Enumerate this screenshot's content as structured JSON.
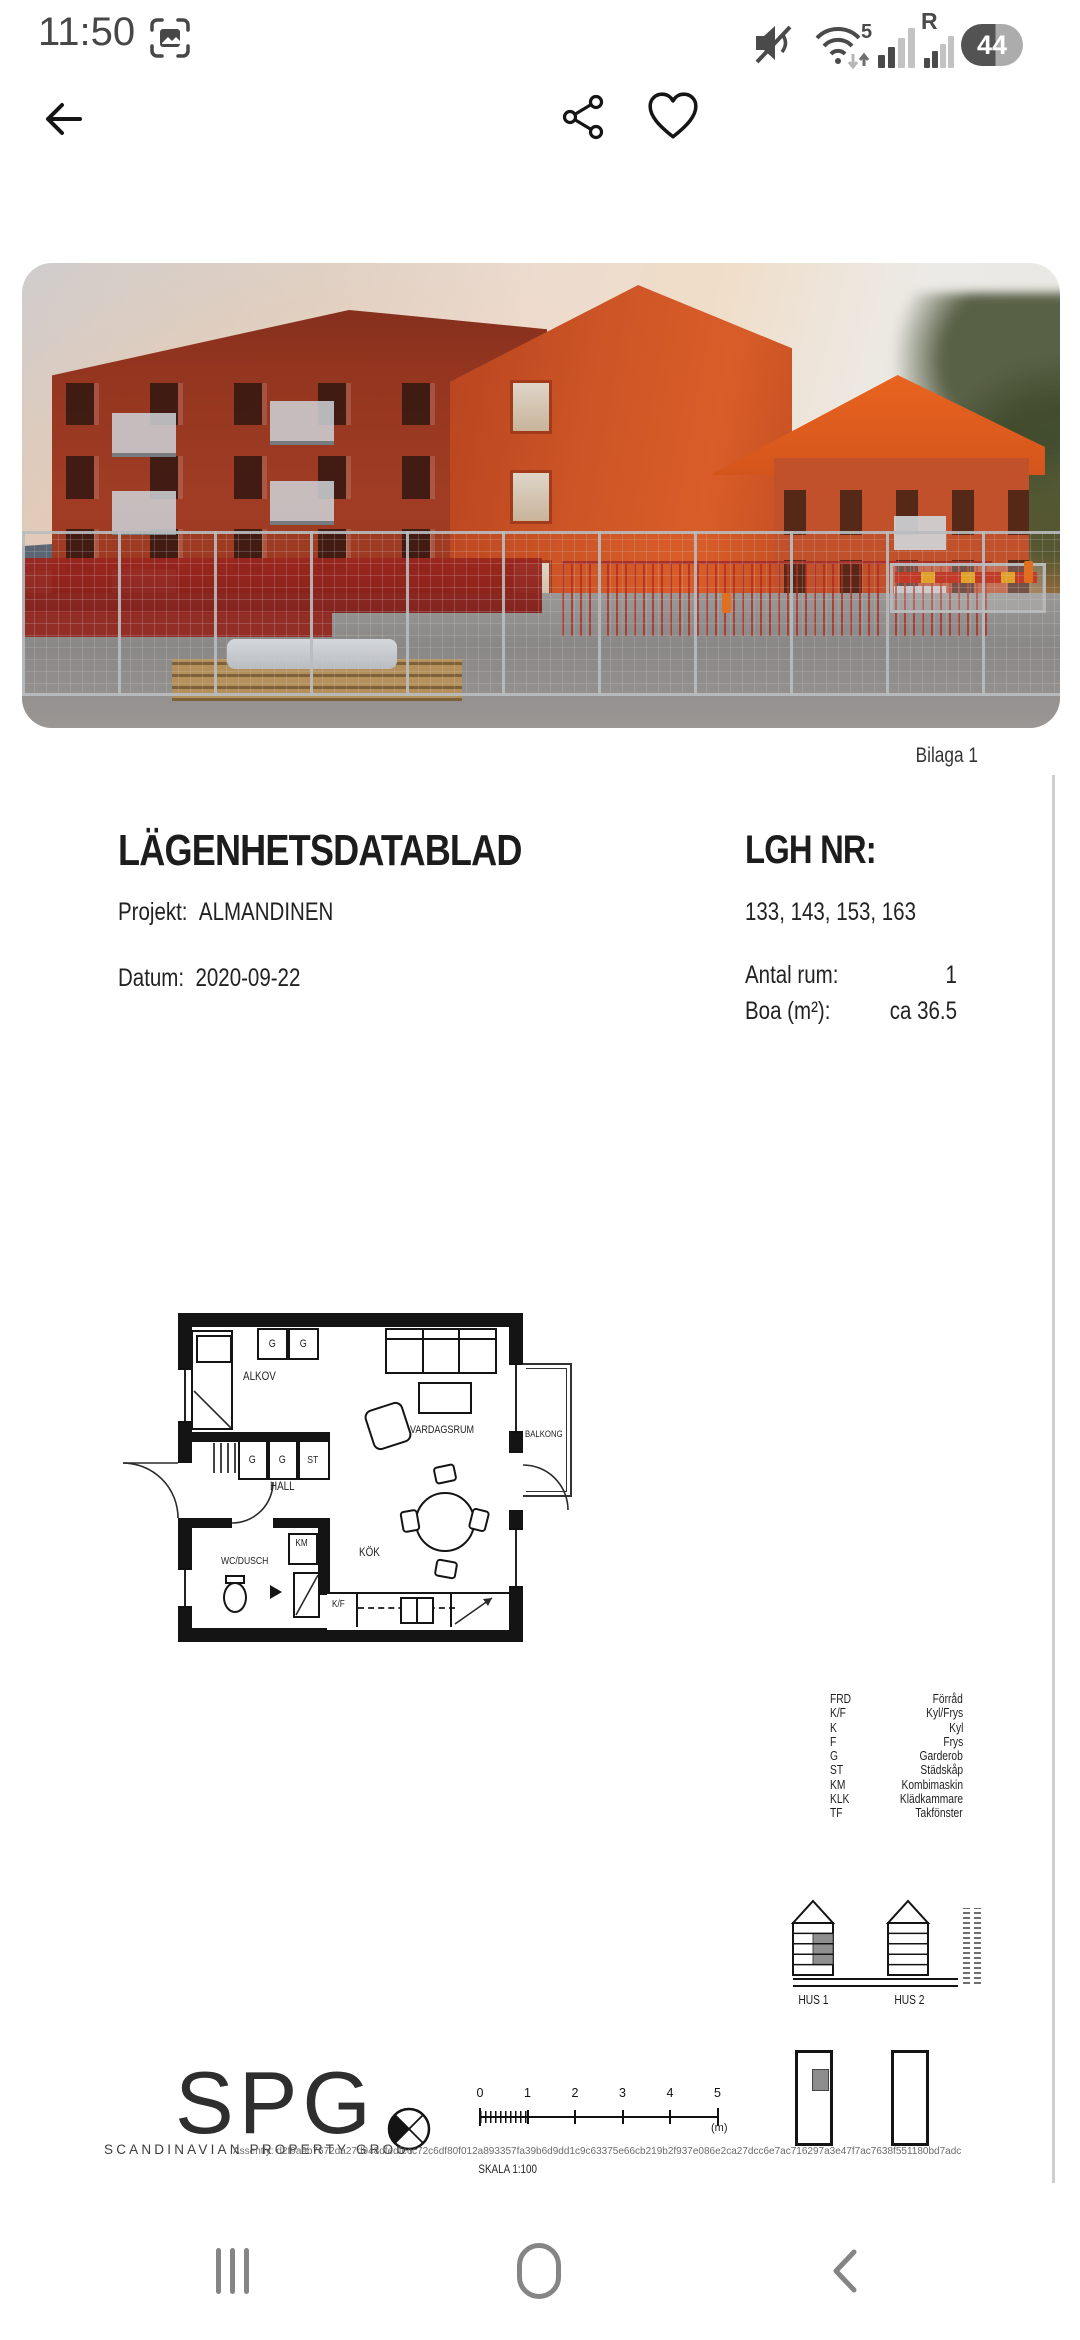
{
  "status_bar": {
    "time": "11:50",
    "network_5g_label": "5",
    "roaming_label": "R",
    "battery_percent": "44"
  },
  "document": {
    "attachment_label": "Bilaga 1",
    "title": "LÄGENHETSDATABLAD",
    "lgh_nr_label": "LGH NR:",
    "lgh_nr_value": "133, 143, 153, 163",
    "projekt_label": "Projekt:",
    "projekt_value": "ALMANDINEN",
    "datum_label": "Datum:",
    "datum_value": "2020-09-22",
    "antal_rum_label": "Antal rum:",
    "antal_rum_value": "1",
    "boa_label": "Boa (m²):",
    "boa_value": "ca 36.5"
  },
  "floor_plan": {
    "labels": {
      "alkov": "ALKOV",
      "vardagsrum": "VARDAGSRUM",
      "balkong": "BALKONG",
      "hall": "HALL",
      "wc_dusch": "WC/DUSCH",
      "kok": "KÖK",
      "km": "KM",
      "kf": "K/F",
      "st": "ST",
      "g": "G"
    }
  },
  "legend": {
    "rows": [
      {
        "abbr": "FRD",
        "name": "Förråd"
      },
      {
        "abbr": "K/F",
        "name": "Kyl/Frys"
      },
      {
        "abbr": "K",
        "name": "Kyl"
      },
      {
        "abbr": "F",
        "name": "Frys"
      },
      {
        "abbr": "G",
        "name": "Garderob"
      },
      {
        "abbr": "ST",
        "name": "Städskåp"
      },
      {
        "abbr": "KM",
        "name": "Kombimaskin"
      },
      {
        "abbr": "KLK",
        "name": "Klädkammare"
      },
      {
        "abbr": "TF",
        "name": "Takfönster"
      }
    ]
  },
  "buildings": {
    "hus1_label": "HUS 1",
    "hus2_label": "HUS 2"
  },
  "footer": {
    "logo_text": "SPG",
    "logo_subtitle": "SCANDINAVIAN PROPERTY GROUP",
    "assently_line": "Assently: d2f9a9b7672da27d948dfedfecc72c6df80f012a893357fa39b6d9dd1c9c63375e66cb219b2f937e086e2ca27dcc6e7ac716297a3e47f7ac7638f551180bd7adc",
    "skala_label": "SKALA 1:100",
    "scale_unit_label": "(m)",
    "scale_ticks": [
      "0",
      "1",
      "2",
      "3",
      "4",
      "5"
    ]
  }
}
